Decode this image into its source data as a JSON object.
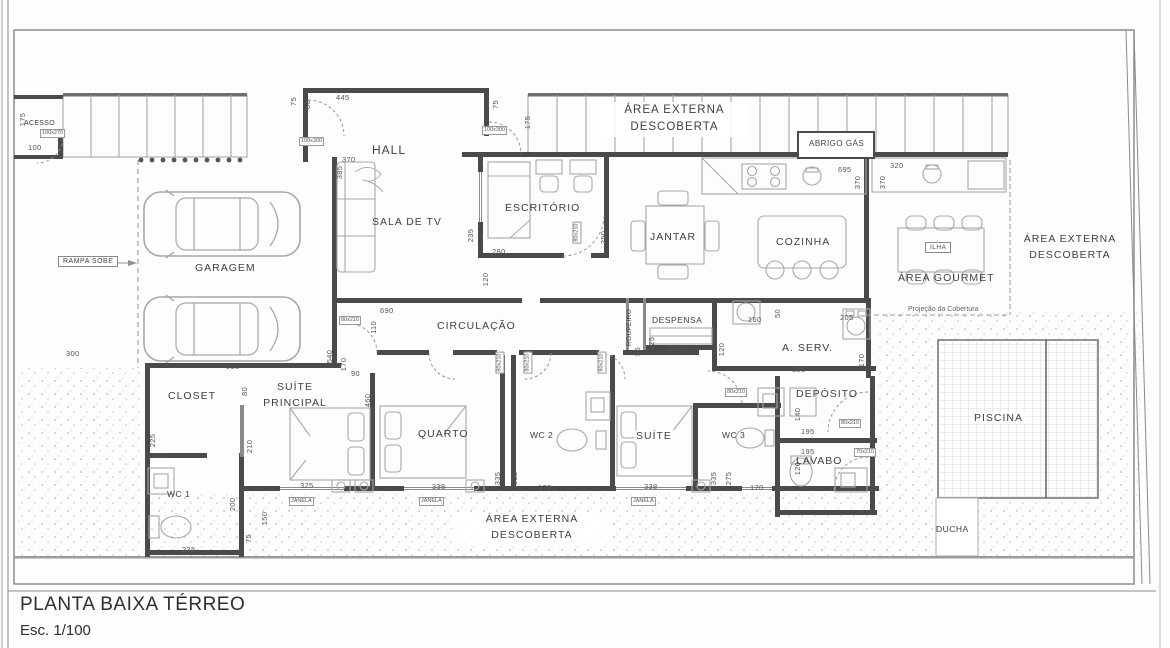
{
  "title": {
    "name": "PLANTA BAIXA TÉRREO",
    "scale": "Esc. 1/100"
  },
  "rooms": {
    "acesso": "ACESSO",
    "garagem": "GARAGEM",
    "hall": "HALL",
    "sala_tv": "SALA DE TV",
    "escritorio": "ESCRITÓRIO",
    "jantar": "JANTAR",
    "cozinha": "COZINHA",
    "area_gourmet": "ÁREA GOURMET",
    "circulacao": "CIRCULAÇÃO",
    "despensa": "DESPENSA",
    "a_serv": "A. SERV.",
    "deposito": "DEPÓSITO",
    "lavabo": "LAVABO",
    "closet": "CLOSET",
    "suite_principal": "SUÍTE PRINCIPAL",
    "quarto": "QUARTO",
    "suite": "SUÍTE",
    "wc1": "WC 1",
    "wc2": "WC 2",
    "wc3": "WC 3",
    "piscina": "PISCINA",
    "ducha": "DUCHA"
  },
  "areas": {
    "externa_descoberta": "ÁREA EXTERNA DESCOBERTA"
  },
  "labels": {
    "rampa": "RAMPA SOBE",
    "abrigo_gas": "ABRIGO GÁS",
    "ilha": "ILHA",
    "projecao": "Projeção da Cobertura",
    "roupeiro": "ROUPEIRO"
  },
  "colors": {
    "wall": "#4a4a4a",
    "thin_line": "#9aa0a6",
    "text": "#3f3f3f",
    "dim_text": "#565656",
    "ground_dot": "#c9c9c3"
  },
  "tags": [
    {
      "t": "100x270",
      "x": 40,
      "y": 129,
      "v": 0
    },
    {
      "t": "100x300",
      "x": 299,
      "y": 137,
      "v": 0
    },
    {
      "t": "100x300",
      "x": 482,
      "y": 126,
      "v": 0
    },
    {
      "t": "80x210",
      "x": 339,
      "y": 316,
      "v": 0
    },
    {
      "t": "80x210",
      "x": 566,
      "y": 228,
      "v": 1
    },
    {
      "t": "80x210",
      "x": 489,
      "y": 358,
      "v": 1
    },
    {
      "t": "80x210",
      "x": 517,
      "y": 358,
      "v": 1
    },
    {
      "t": "80x210",
      "x": 591,
      "y": 358,
      "v": 1
    },
    {
      "t": "80x210",
      "x": 725,
      "y": 388,
      "v": 0
    },
    {
      "t": "80x210",
      "x": 839,
      "y": 419,
      "v": 0
    },
    {
      "t": "70x210",
      "x": 854,
      "y": 448,
      "v": 0
    },
    {
      "t": "JANELA",
      "x": 289,
      "y": 497,
      "v": 0
    },
    {
      "t": "JANELA",
      "x": 419,
      "y": 497,
      "v": 0
    },
    {
      "t": "JANELA",
      "x": 631,
      "y": 497,
      "v": 0
    }
  ],
  "dims": [
    {
      "t": "175",
      "x": 16,
      "y": 115,
      "v": 1
    },
    {
      "t": "100",
      "x": 28,
      "y": 143,
      "v": 0
    },
    {
      "t": "75",
      "x": 289,
      "y": 97,
      "v": 1
    },
    {
      "t": "60",
      "x": 303,
      "y": 100,
      "v": 1
    },
    {
      "t": "445",
      "x": 336,
      "y": 93,
      "v": 0
    },
    {
      "t": "75",
      "x": 491,
      "y": 100,
      "v": 1
    },
    {
      "t": "175",
      "x": 521,
      "y": 118,
      "v": 1
    },
    {
      "t": "370",
      "x": 342,
      "y": 155,
      "v": 0
    },
    {
      "t": "385",
      "x": 333,
      "y": 168,
      "v": 1
    },
    {
      "t": "235",
      "x": 464,
      "y": 231,
      "v": 1
    },
    {
      "t": "280",
      "x": 492,
      "y": 247,
      "v": 0
    },
    {
      "t": "250",
      "x": 597,
      "y": 233,
      "v": 1
    },
    {
      "t": "120",
      "x": 479,
      "y": 275,
      "v": 1
    },
    {
      "t": "695",
      "x": 838,
      "y": 165,
      "v": 0
    },
    {
      "t": "370",
      "x": 851,
      "y": 178,
      "v": 1
    },
    {
      "t": "370",
      "x": 876,
      "y": 178,
      "v": 1
    },
    {
      "t": "320",
      "x": 890,
      "y": 161,
      "v": 0
    },
    {
      "t": "300",
      "x": 66,
      "y": 349,
      "v": 0
    },
    {
      "t": "500",
      "x": 226,
      "y": 362,
      "v": 0
    },
    {
      "t": "540",
      "x": 323,
      "y": 352,
      "v": 1
    },
    {
      "t": "170",
      "x": 337,
      "y": 360,
      "v": 1
    },
    {
      "t": "90",
      "x": 351,
      "y": 369,
      "v": 0
    },
    {
      "t": "690",
      "x": 380,
      "y": 306,
      "v": 0
    },
    {
      "t": "110",
      "x": 367,
      "y": 323,
      "v": 1
    },
    {
      "t": "80",
      "x": 240,
      "y": 387,
      "v": 1
    },
    {
      "t": "460",
      "x": 361,
      "y": 396,
      "v": 1
    },
    {
      "t": "225",
      "x": 146,
      "y": 436,
      "v": 1
    },
    {
      "t": "235",
      "x": 153,
      "y": 451,
      "v": 0
    },
    {
      "t": "210",
      "x": 243,
      "y": 442,
      "v": 1
    },
    {
      "t": "200",
      "x": 226,
      "y": 500,
      "v": 1
    },
    {
      "t": "150",
      "x": 258,
      "y": 514,
      "v": 1
    },
    {
      "t": "75",
      "x": 244,
      "y": 534,
      "v": 1
    },
    {
      "t": "235",
      "x": 182,
      "y": 545,
      "v": 0
    },
    {
      "t": "325",
      "x": 300,
      "y": 481,
      "v": 0
    },
    {
      "t": "338",
      "x": 432,
      "y": 482,
      "v": 0
    },
    {
      "t": "335",
      "x": 491,
      "y": 474,
      "v": 1
    },
    {
      "t": "335",
      "x": 508,
      "y": 474,
      "v": 1
    },
    {
      "t": "170",
      "x": 538,
      "y": 483,
      "v": 0
    },
    {
      "t": "338",
      "x": 644,
      "y": 482,
      "v": 0
    },
    {
      "t": "335",
      "x": 707,
      "y": 474,
      "v": 1
    },
    {
      "t": "275",
      "x": 722,
      "y": 474,
      "v": 1
    },
    {
      "t": "170",
      "x": 750,
      "y": 483,
      "v": 0
    },
    {
      "t": "165",
      "x": 668,
      "y": 344,
      "v": 0
    },
    {
      "t": "125",
      "x": 645,
      "y": 339,
      "v": 1
    },
    {
      "t": "55",
      "x": 633,
      "y": 347,
      "v": 1
    },
    {
      "t": "160",
      "x": 748,
      "y": 315,
      "v": 0
    },
    {
      "t": "50",
      "x": 773,
      "y": 309,
      "v": 1
    },
    {
      "t": "380",
      "x": 792,
      "y": 365,
      "v": 0
    },
    {
      "t": "120",
      "x": 715,
      "y": 345,
      "v": 1
    },
    {
      "t": "205",
      "x": 840,
      "y": 313,
      "v": 0
    },
    {
      "t": "170",
      "x": 855,
      "y": 356,
      "v": 1
    },
    {
      "t": "140",
      "x": 791,
      "y": 410,
      "v": 1
    },
    {
      "t": "195",
      "x": 801,
      "y": 427,
      "v": 0
    },
    {
      "t": "195",
      "x": 801,
      "y": 447,
      "v": 0
    },
    {
      "t": "120",
      "x": 791,
      "y": 464,
      "v": 1
    }
  ]
}
